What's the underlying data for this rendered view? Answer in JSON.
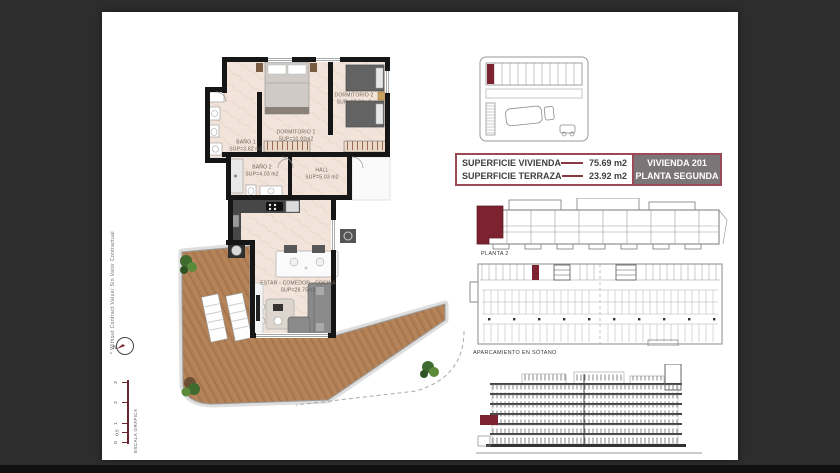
{
  "colors": {
    "background": "#2d2d2d",
    "sheet": "#ffffff",
    "accent_maroon": "#7c2230",
    "table_border": "#9b4a55",
    "panel_gray": "#7b7577",
    "deck_wood": "#b28055"
  },
  "floor_plan": {
    "rooms": [
      {
        "name": "DORMITORIO 1",
        "area": "SUP=10.92m2"
      },
      {
        "name": "DORMITORIO 2",
        "area": "SUP=10.04m2"
      },
      {
        "name": "BAÑO 1",
        "area": "SUP=3.82 m2"
      },
      {
        "name": "BAÑO 2",
        "area": "SUP=4.03 m2"
      },
      {
        "name": "HALL",
        "area": "SUP=5.03 m2"
      },
      {
        "name": "ESTAR - COMEDOR - COCINA",
        "area": "SUP=28.75m2"
      }
    ]
  },
  "info_table": {
    "rows": [
      {
        "label": "SUPERFICIE VIVIENDA",
        "value": "75.69 m2"
      },
      {
        "label": "SUPERFICIE TERRAZA",
        "value": "23.92 m2"
      }
    ],
    "unit_name": "VIVIENDA 201",
    "unit_floor": "PLANTA SEGUNDA"
  },
  "diagrams": {
    "planta_label": "PLANTA 2",
    "parking_label": "APARCAMIENTO EN SÓTANO"
  },
  "margin": {
    "disclaimer": "* Without Contract Value/ Sin Valor Contractual",
    "scale_title": "ESCALA GRÁFICA",
    "north": "N",
    "scale_ticks": [
      "3",
      "2",
      "1",
      "0.5",
      "0"
    ]
  }
}
